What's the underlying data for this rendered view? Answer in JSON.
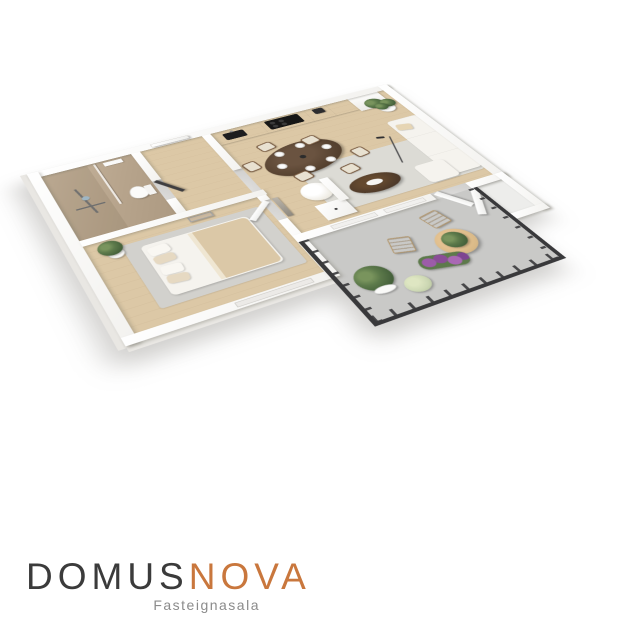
{
  "branding": {
    "logo_primary": "DOMUS",
    "logo_secondary": "NOVA",
    "tagline": "Fasteignasala",
    "logo_primary_color": "#3b3b3b",
    "logo_secondary_color": "#c9773d",
    "tagline_color": "#8b8b8b"
  },
  "scene": {
    "type": "3d-isometric-floor-plan-render",
    "rooms": [
      "bathroom",
      "entry-hall",
      "kitchen",
      "dining-area",
      "living-area",
      "inner-hall",
      "bedroom",
      "balcony",
      "storage"
    ],
    "furniture": [
      "kitchen-counter",
      "cooktop",
      "sink",
      "dining-table-6-chairs",
      "lounge-chair",
      "sofa",
      "coffee-table",
      "floor-lamp",
      "palm-plant",
      "double-bed",
      "standing-mirror",
      "hall-mirror",
      "dresser",
      "toilet",
      "walk-in-shower",
      "patio-chairs",
      "patio-table",
      "balcony-plants",
      "purple-flowers"
    ],
    "palette": {
      "wall": "#ffffff",
      "wood_floor": "#dcc8a6",
      "tile_floor": "#c0ae97",
      "living_rug": "#dcdbd5",
      "bedroom_rug": "#d2d1cd",
      "sofa": "#f5f3ee",
      "dining_table_wood": "#54402e",
      "coffee_table_wood": "#4e3a2a",
      "blanket": "#dbc8a7",
      "balcony_floor": "#c9c9c7",
      "railing": "#39393b",
      "patio_wood": "#d9b987",
      "plant_green": "#5d7a4b",
      "flower_purple": "#9c5ca8"
    }
  }
}
